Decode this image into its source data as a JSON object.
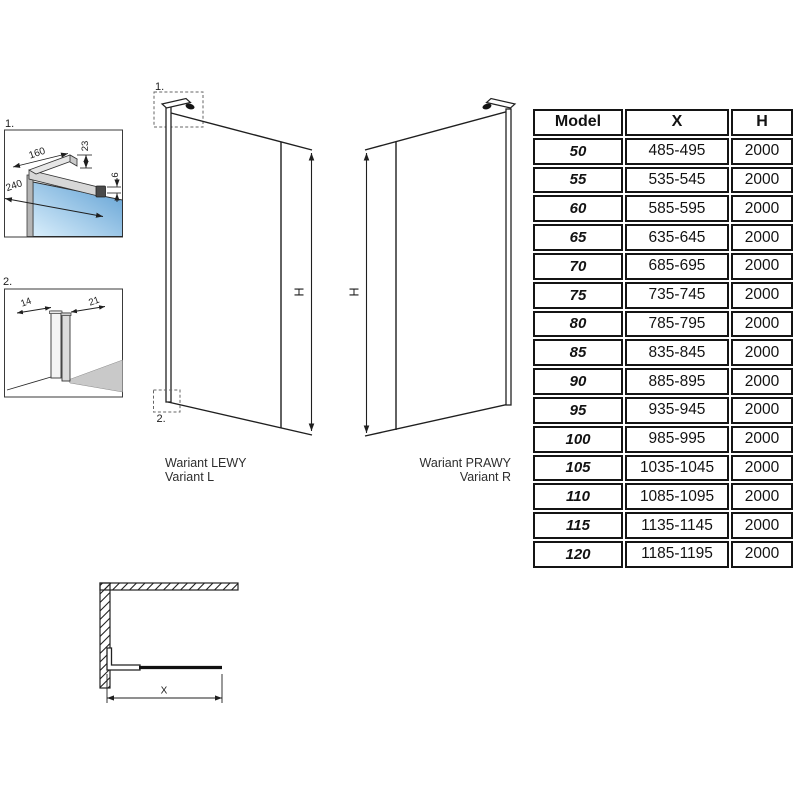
{
  "colors": {
    "line": "#1f1f1f",
    "glass_light": "#d9eefb",
    "glass_dark": "#5e9fd3",
    "metal_light": "#e6e6e6",
    "metal_mid": "#d7d7d7",
    "metal_dark": "#4a4a4a",
    "wall_gray": "#b5b5b5",
    "floor_gray": "#c9c9c9"
  },
  "detail_1": {
    "label": "1.",
    "dim_arm": "160",
    "dim_depth": "240",
    "dim_height": "23",
    "dim_gap": "6"
  },
  "detail_2": {
    "label": "2.",
    "dim_left": "14",
    "dim_right": "21"
  },
  "variant_left": {
    "callout_top": "1.",
    "callout_bottom": "2.",
    "height_label": "H",
    "caption_pl": "Wariant LEWY",
    "caption_en": "Variant L"
  },
  "variant_right": {
    "height_label": "H",
    "caption_pl": "Wariant PRAWY",
    "caption_en": "Variant R"
  },
  "plan_view": {
    "width_label": "X"
  },
  "spec_table": {
    "headers": {
      "model": "Model",
      "x": "X",
      "h": "H"
    },
    "rows": [
      {
        "model": "50",
        "x": "485-495",
        "h": "2000"
      },
      {
        "model": "55",
        "x": "535-545",
        "h": "2000"
      },
      {
        "model": "60",
        "x": "585-595",
        "h": "2000"
      },
      {
        "model": "65",
        "x": "635-645",
        "h": "2000"
      },
      {
        "model": "70",
        "x": "685-695",
        "h": "2000"
      },
      {
        "model": "75",
        "x": "735-745",
        "h": "2000"
      },
      {
        "model": "80",
        "x": "785-795",
        "h": "2000"
      },
      {
        "model": "85",
        "x": "835-845",
        "h": "2000"
      },
      {
        "model": "90",
        "x": "885-895",
        "h": "2000"
      },
      {
        "model": "95",
        "x": "935-945",
        "h": "2000"
      },
      {
        "model": "100",
        "x": "985-995",
        "h": "2000"
      },
      {
        "model": "105",
        "x": "1035-1045",
        "h": "2000"
      },
      {
        "model": "110",
        "x": "1085-1095",
        "h": "2000"
      },
      {
        "model": "115",
        "x": "1135-1145",
        "h": "2000"
      },
      {
        "model": "120",
        "x": "1185-1195",
        "h": "2000"
      }
    ]
  }
}
